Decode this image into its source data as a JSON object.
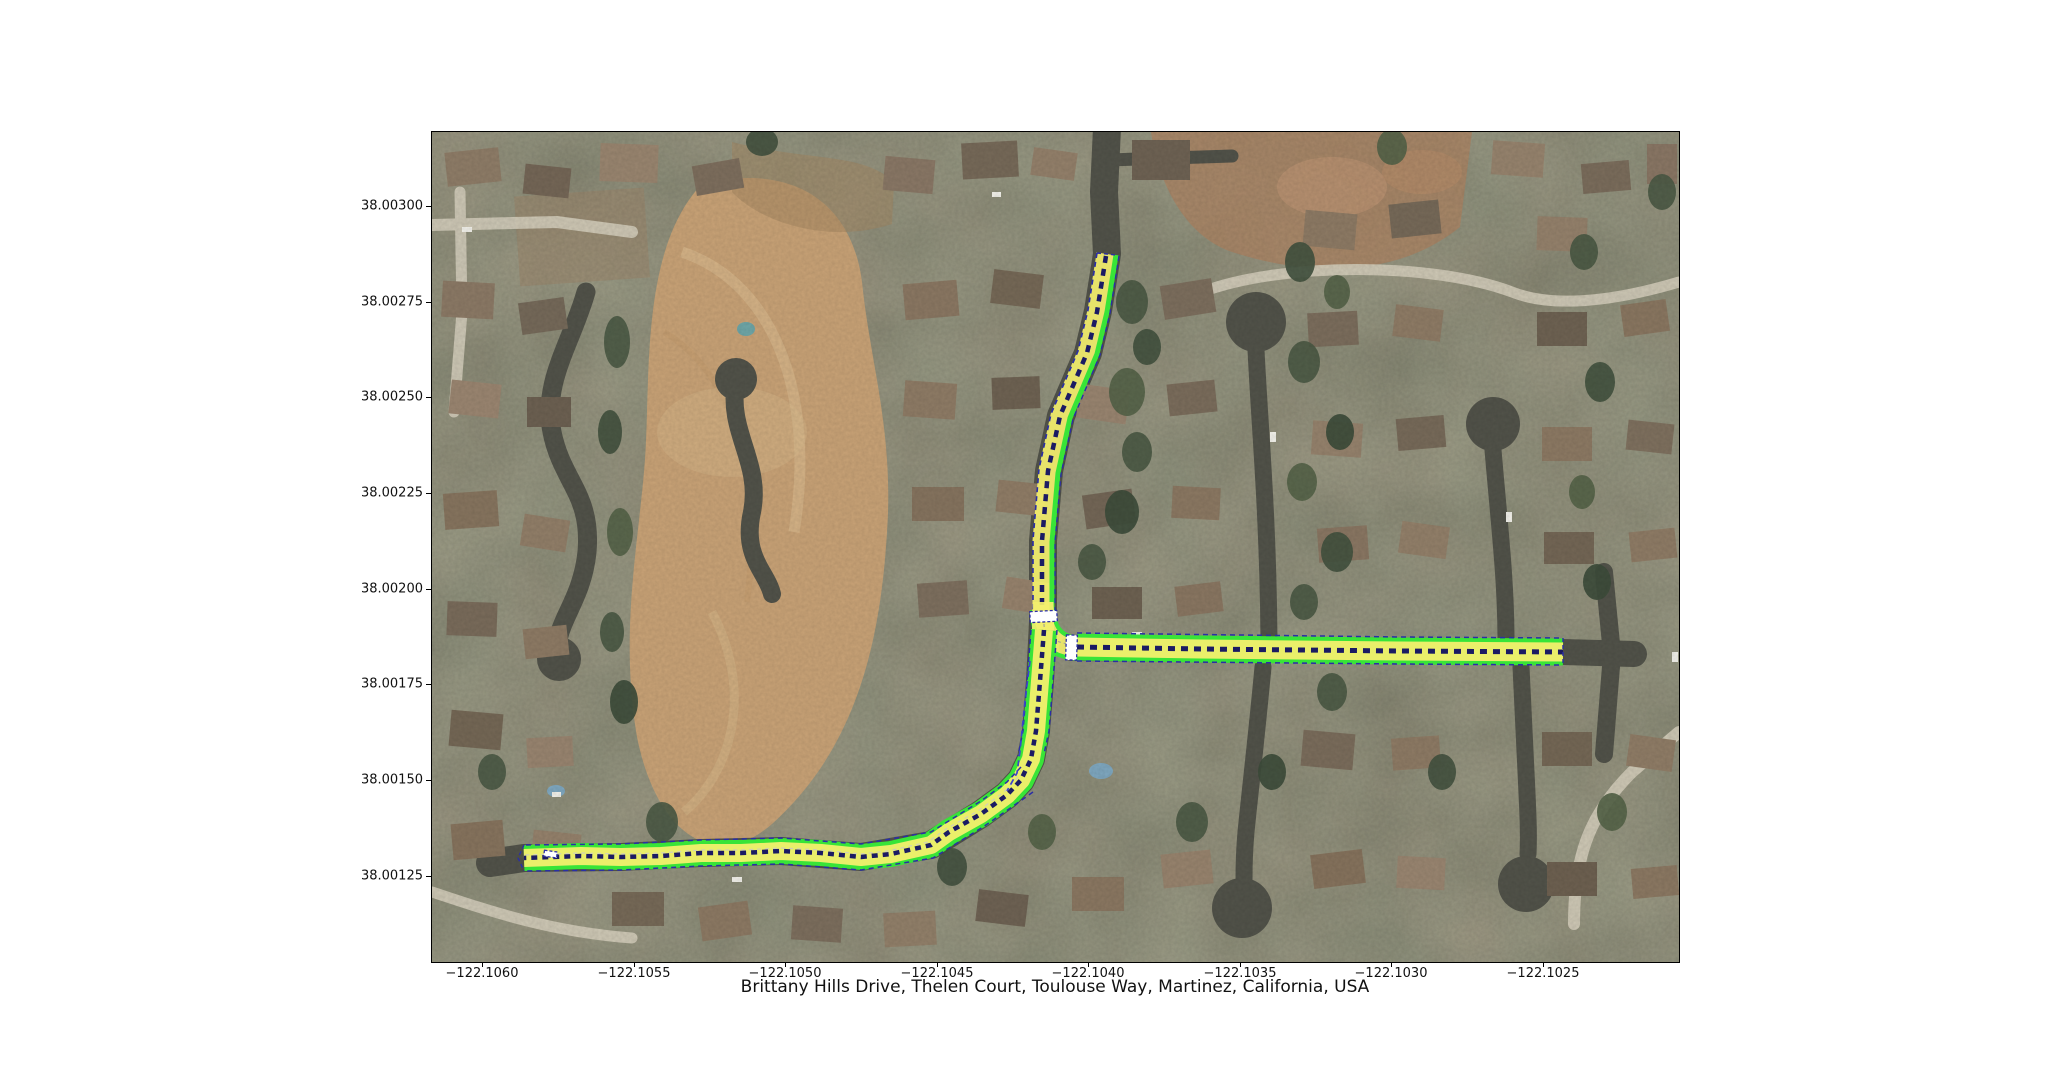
{
  "figure": {
    "xlabel": "Brittany Hills Drive, Thelen Court, Toulouse Way, Martinez, California, USA",
    "x_ticks": [
      "−122.1060",
      "−122.1055",
      "−122.1050",
      "−122.1045",
      "−122.1040",
      "−122.1035",
      "−122.1030",
      "−122.1025"
    ],
    "y_ticks": [
      "38.00300",
      "38.00275",
      "38.00250",
      "38.00225",
      "38.00200",
      "38.00175",
      "38.00150",
      "38.00125"
    ]
  },
  "map": {
    "type": "satellite-aerial",
    "location": "Martinez, California, USA",
    "highlighted_streets": [
      "Brittany Hills Drive",
      "Thelen Court",
      "Toulouse Way"
    ],
    "overlay_colors": {
      "road_fill_yellow": "#f3ef6d",
      "road_edge_green": "#38e438",
      "centerline_navy": "#1b1b63",
      "lane_dash_blue": "#2a2ea6",
      "stop_line_white": "#ffffff"
    }
  }
}
